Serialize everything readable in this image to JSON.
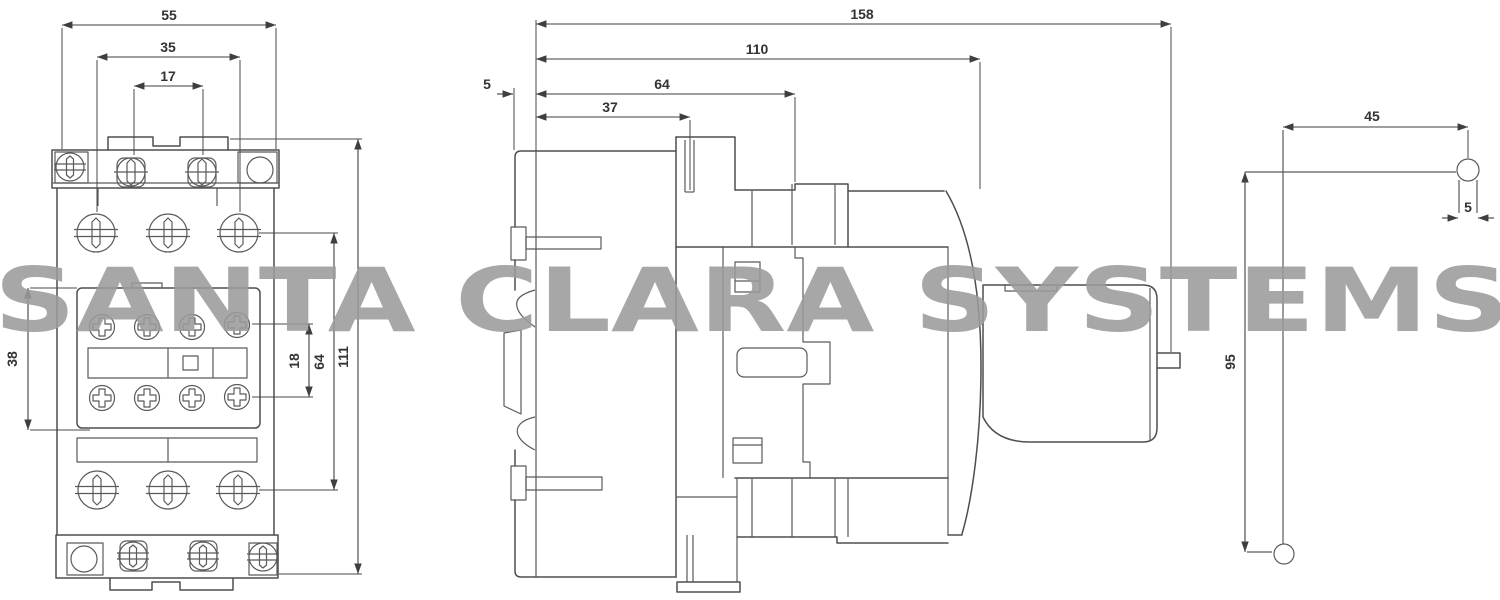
{
  "watermark": {
    "text": "SANTA CLARA SYSTEMS",
    "color": "#9b9b9b"
  },
  "colors": {
    "line": "#4e4e4e",
    "dimension": "#3f3f3f",
    "background": "#ffffff"
  },
  "views": {
    "front": {
      "label": "front-view",
      "dims": {
        "overall_width": "55",
        "mounting_width": "35",
        "terminal_spacing": "17",
        "aux_block_height": "38",
        "aux_screw_spacing": "18",
        "screw_row_spacing": "64",
        "overall_height": "111"
      }
    },
    "side": {
      "label": "side-view",
      "dims": {
        "overall_depth": "158",
        "body_depth": "110",
        "aux_terminal_depth": "64",
        "fin_depth": "37",
        "din_clip_depth": "5"
      }
    },
    "lever": {
      "label": "lever-view",
      "dims": {
        "horizontal_reach": "45",
        "pin_width": "5",
        "vertical_length": "95"
      }
    }
  }
}
